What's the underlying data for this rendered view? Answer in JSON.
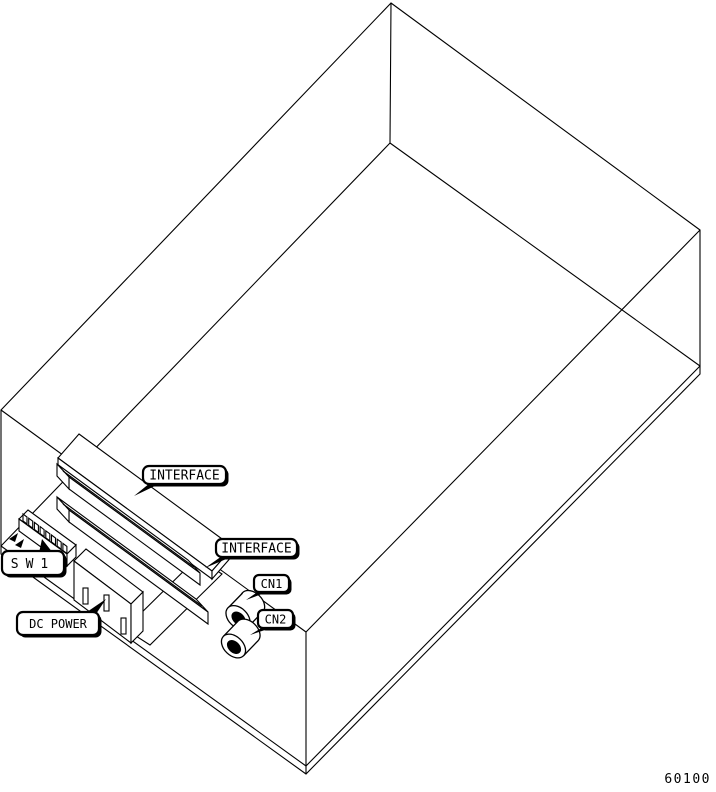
{
  "figure": {
    "number": "60100",
    "description": "Isometric wireframe drawing of equipment enclosure showing bottom-panel components"
  },
  "colors": {
    "line": "#000000",
    "background": "#ffffff",
    "label_fill": "#ffffff",
    "label_border": "#000000"
  },
  "callouts": {
    "interface1": {
      "label": "INTERFACE",
      "target": "upper interface connector bar"
    },
    "interface2": {
      "label": "INTERFACE",
      "target": "lower interface connector bar"
    },
    "sw1": {
      "label": "SW1",
      "target": "DIP switch block"
    },
    "dc_power": {
      "label": "DC POWER",
      "target": "power terminal slot on power module"
    },
    "cn1": {
      "label": "CN1",
      "target": "upper round connector"
    },
    "cn2": {
      "label": "CN2",
      "target": "lower round connector"
    }
  }
}
